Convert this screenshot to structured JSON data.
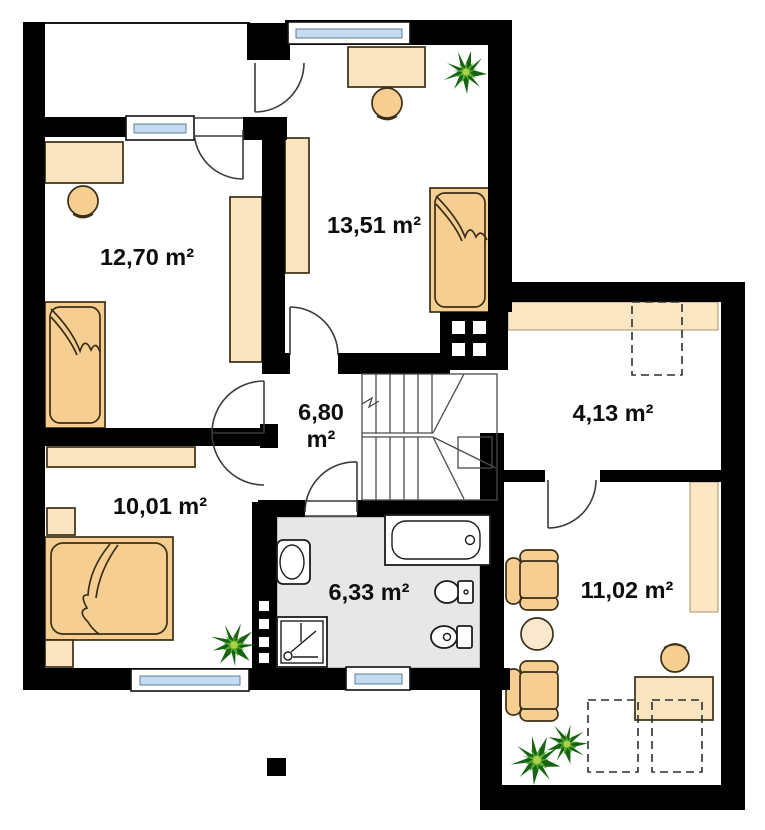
{
  "plan_title": "attic floor plan",
  "rooms": [
    {
      "id": "bedroom-left",
      "area": "12,70 m²"
    },
    {
      "id": "bedroom-top",
      "area": "13,51 m²"
    },
    {
      "id": "hall",
      "area_value": "6,80",
      "area_unit": "m²"
    },
    {
      "id": "landing",
      "area": "4,13 m²"
    },
    {
      "id": "bedroom-lower",
      "area": "10,01 m²"
    },
    {
      "id": "bathroom",
      "area": "6,33 m²"
    },
    {
      "id": "study",
      "area": "11,02 m²"
    }
  ],
  "colors": {
    "wall": "#000000",
    "furniture_light": "#FAE5C0",
    "furniture_mid": "#F6CE92",
    "furniture_pale": "#FBE9CF",
    "window_glass": "#C3DCF2",
    "bathroom_floor": "#E7E7E7",
    "band": "#FBE7C4",
    "plant_dark": "#166312",
    "plant_light": "#57A82E",
    "outline": "#3A2F15"
  }
}
